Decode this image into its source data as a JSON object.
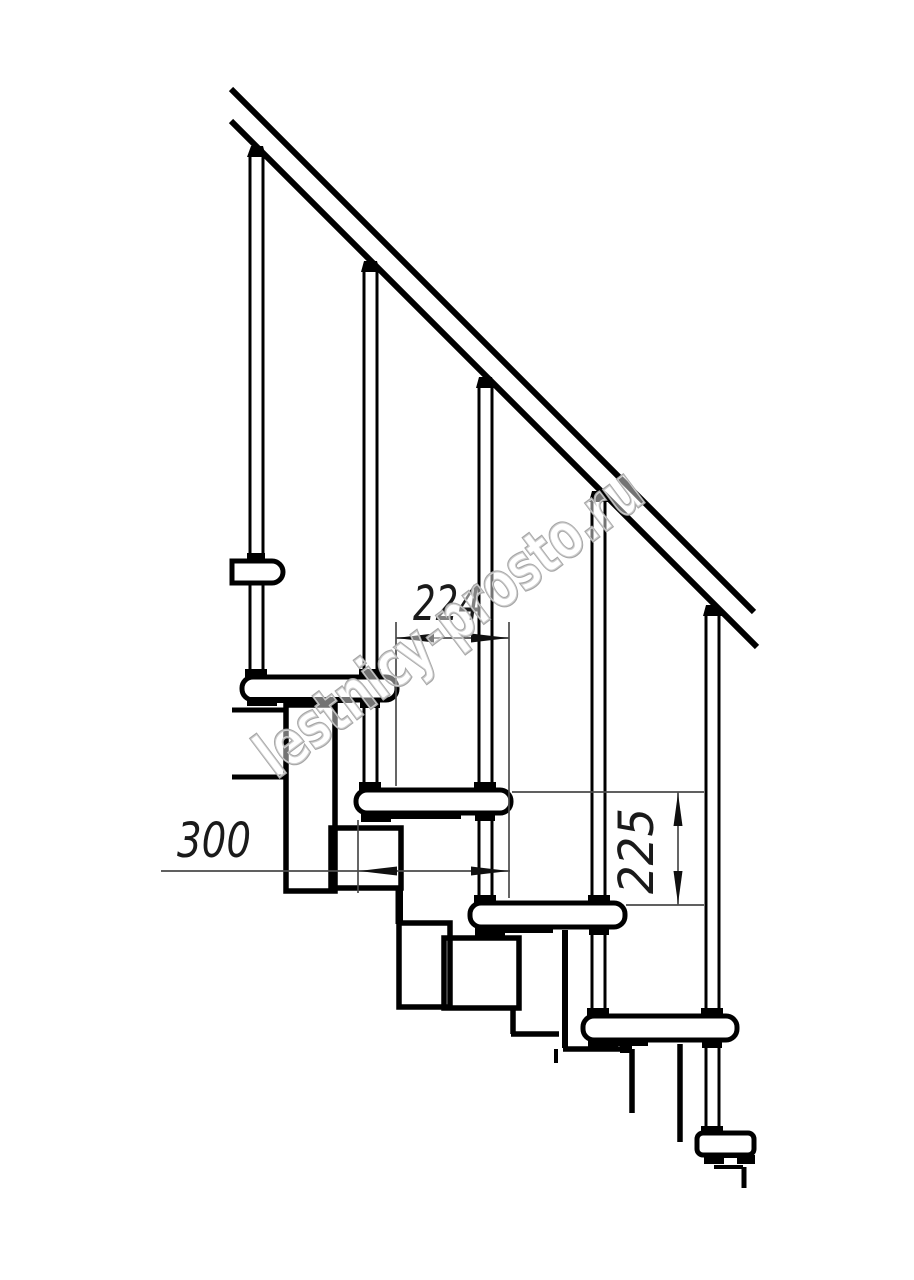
{
  "drawing": {
    "dimensions": {
      "step_run": "224",
      "tread_length": "300",
      "step_rise": "225"
    },
    "watermark_text": "lestnicy-prosto.ru",
    "colors": {
      "outline": "#000000",
      "dimension_line": "#4a4a4a",
      "dimension_text": "#1a1a1a",
      "watermark_stroke": "#a6a6a6",
      "background": "#ffffff"
    }
  }
}
